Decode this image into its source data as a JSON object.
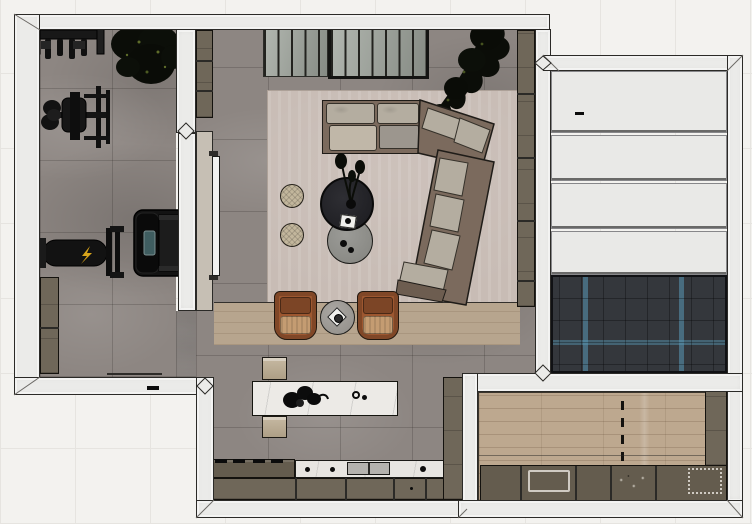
{
  "scene": {
    "title": "apartment-floor-plan-top-view",
    "style": "3d-rendered orthographic top view, SketchUp-like, no visible text",
    "canvas": {
      "width": 752,
      "height": 524
    }
  },
  "colors": {
    "bg": "#f3f2ef",
    "bg_grid": "#e6e4e0",
    "wall": "#ebebe9",
    "line": "#2b2a27",
    "floor": "#8d8682",
    "rug": "#c8bcb5",
    "rug_line": "#ada198",
    "wood_band": "#b7a58e",
    "sofa_frame": "#7b6a5d",
    "cushion": "#b4ada0",
    "chaise": "#c0b7a8",
    "table_dark": "#232327",
    "table_gray": "#90908c",
    "pouf": "#c2b69c",
    "chair": "#9d5730",
    "chair_dark": "#7c4526",
    "chair_cushion": "#c49c72",
    "island_marble": "#eceae6",
    "cabinet": "#6f6759",
    "cabinet_dark": "#645c4e",
    "counter_white": "#e7e5e1",
    "panel_white": "#e9e9e7",
    "herring_base": "#34373c",
    "herring_blue": "#4e86a0",
    "wood_floor": "#bda88f",
    "equipment": "#141414",
    "accent_yellow": "#d9a51b",
    "plant": "#0b0d08",
    "inner_wall_face": "#c6bfb4",
    "tv_panel": "#f2f2f0",
    "slat_panel": "#a9aea8",
    "slat_line": "#23231f"
  },
  "rooms": [
    {
      "name": "home-gym",
      "floor": "gray marble tile",
      "items": [
        "wall-mounted weight rack",
        "potted plant",
        "cable multi-gym machine",
        "treadmill",
        "weight bench",
        "low cabinet"
      ]
    },
    {
      "name": "living-room",
      "floor": "gray marble tile with area rug and wood strip",
      "items": [
        "slatted glass partition (2 sections)",
        "L-shaped sectional sofa with angled chaise",
        "round dark coffee table with plant and book",
        "round gray side table",
        "2 round rattan poufs",
        "2 cognac leather armchairs",
        "round side table with tray",
        "tall console cabinet",
        "wall-mounted panel (TV)",
        "tall indoor tree"
      ]
    },
    {
      "name": "kitchen",
      "floor": "gray marble tile",
      "items": [
        "marble kitchen island with flower decor",
        "2 upholstered benches",
        "cooktop counter",
        "white marble counter with sink",
        "base cabinets",
        "tall cabinet column"
      ]
    },
    {
      "name": "garage-room",
      "floor": "white panel bays and dark herringbone parquet with blue accents",
      "items": [
        "4 white panel sections",
        "herringbone floor area"
      ]
    },
    {
      "name": "utility-room",
      "floor": "light oak plank",
      "items": [
        "bottom counter with sink and decor",
        "side cabinet",
        "dashed door-swing marking"
      ]
    }
  ]
}
